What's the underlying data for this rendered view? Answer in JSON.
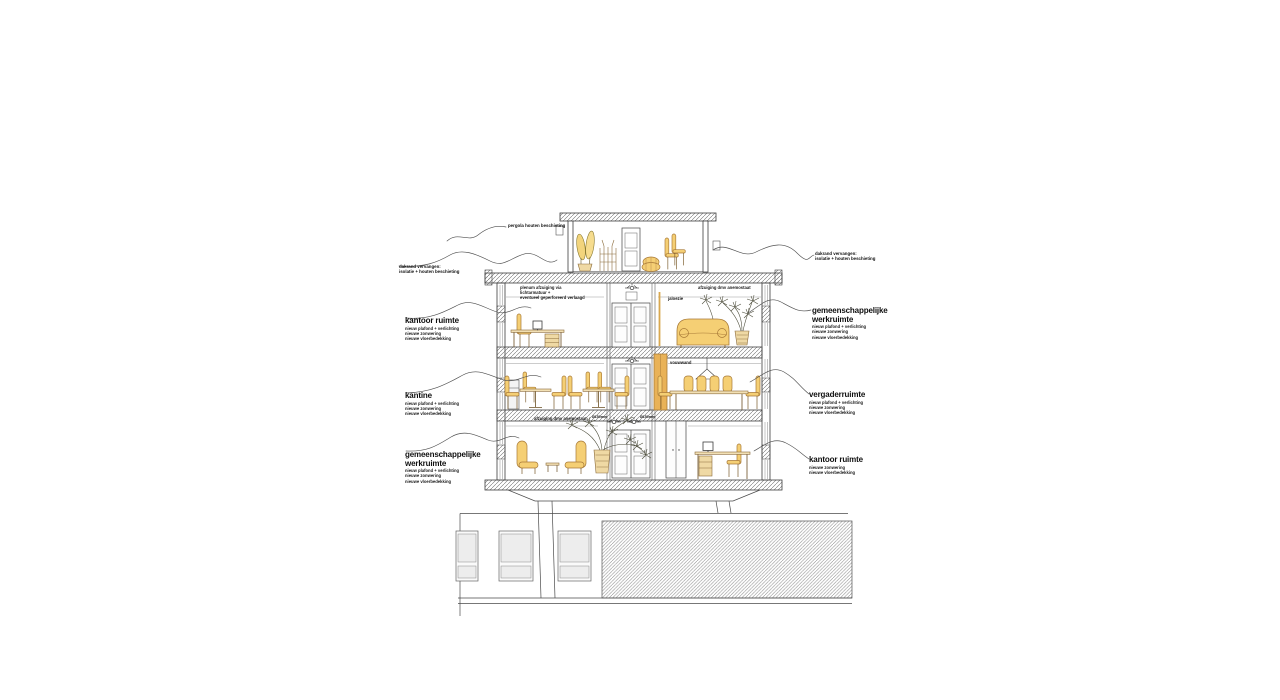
{
  "drawing": {
    "kind": "architectural section sketch of a three-storey office building with rooftop pavilion",
    "colors": {
      "paper": "#ffffff",
      "ink": "#3d3d3d",
      "furniture_fill": "#f5cf74",
      "furniture_stroke": "#a87a38",
      "wood_accent": "#e9b257",
      "tan": "#efd9a4"
    }
  },
  "labels": {
    "top": {
      "title": "pergola houten beschieting"
    },
    "left": [
      {
        "title": "dakrand vervangen:",
        "details": [
          "isolatie + houten beschieting"
        ]
      },
      {
        "title": "kantoor ruimte",
        "details": [
          "nieuw plafond + verlichting",
          "nieuwe zonwering",
          "nieuwe vloerbedekking"
        ]
      },
      {
        "title": "kantine",
        "details": [
          "nieuw plafond + verlichting",
          "nieuwe zonwering",
          "nieuwe vloerbedekking"
        ]
      },
      {
        "title": "gemeenschappelijke werkruimte",
        "details": [
          "nieuw plafond + verlichting",
          "nieuwe zonwering",
          "nieuwe vloerbedekking"
        ]
      }
    ],
    "right": [
      {
        "title": "dakrand vervangen:",
        "details": [
          "isolatie + houten beschieting"
        ]
      },
      {
        "title": "gemeenschappelijke werkruimte",
        "details": [
          "nieuw plafond + verlichting",
          "nieuwe zonwering",
          "nieuwe vloerbedekking"
        ]
      },
      {
        "title": "vergaderruimte",
        "details": [
          "nieuw plafond + verlichting",
          "nieuwe zonwering",
          "nieuwe vloerbedekking"
        ]
      },
      {
        "title": "kantoor ruimte",
        "details": [
          "nieuwe zonwering",
          "nieuwe vloerbedekking"
        ]
      }
    ],
    "internal": [
      {
        "id": "plenum-note",
        "lines": [
          "plenum afzuiging via lichtarmatuur +",
          "eventueel geperforeerd verlaagd"
        ]
      },
      {
        "id": "exhaust-upper",
        "lines": [
          "afzuiging dmv anemostaat"
        ]
      },
      {
        "id": "jaloezie",
        "lines": [
          "jaloezie"
        ]
      },
      {
        "id": "vouwwand",
        "lines": [
          "vouwwand"
        ]
      },
      {
        "id": "exhaust-lower",
        "lines": [
          "afzuiging dmv anemostaat"
        ]
      },
      {
        "id": "duct-diameter-left",
        "lines": [
          "Ø150mm"
        ]
      },
      {
        "id": "duct-diameter-right",
        "lines": [
          "Ø150mm"
        ]
      }
    ]
  }
}
